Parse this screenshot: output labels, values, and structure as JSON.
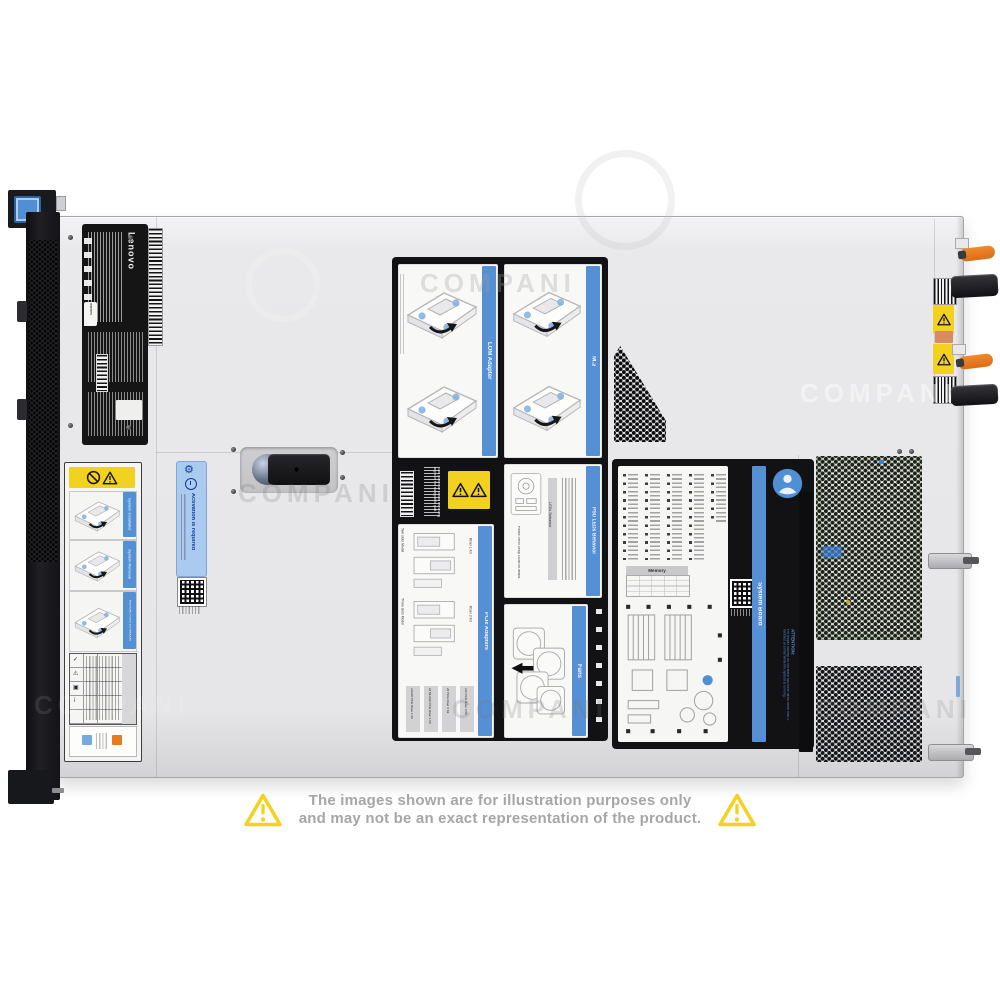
{
  "watermark": "COMPANI",
  "disclaimer": {
    "line1": "The images shown are for illustration purposes only",
    "line2": "and may not be an exact representation of the product."
  },
  "chassis_labels": {
    "brand": "Lenovo",
    "cert_badge": "Intertek",
    "activation": "Activation is required",
    "section_install": "System Installation",
    "section_removal": "System Removal",
    "section_io": "Remove Front I/O Module",
    "lom_title": "LOM Adapter",
    "m2_title": "M.2",
    "psu_title": "PSU LEDs Behavior",
    "psu_table_header": "LEDs Behavior",
    "psu_note": "Please check Setup Guide for details.",
    "power_warning": "Turn power off before removing any non hot swappable part.",
    "pcie_title": "PCIe Adapters",
    "pcie_model_two": "Two slots Model",
    "pcie_model_three": "Three slots Model",
    "pcie_riser1": "Riser 1 Kit",
    "pcie_riser2": "Riser 2 Kit",
    "pcie_kits": [
      "x16/x8 PCIe Riser 1 Kit",
      "x8 ML2/x8 PCIe Riser 1 Kit",
      "x8 PCIe Riser 2 Kit",
      "x16 PCIe Riser 2 Kit"
    ],
    "fans_title": "Fans",
    "board_title": "System Board",
    "board_memory": "Memory",
    "service_info": "Service Information",
    "attention_title": "ATTENTION:",
    "attention_body": "For proper cooling, do not leave top cover off for more than 2 minutes at a time while the system is running."
  }
}
